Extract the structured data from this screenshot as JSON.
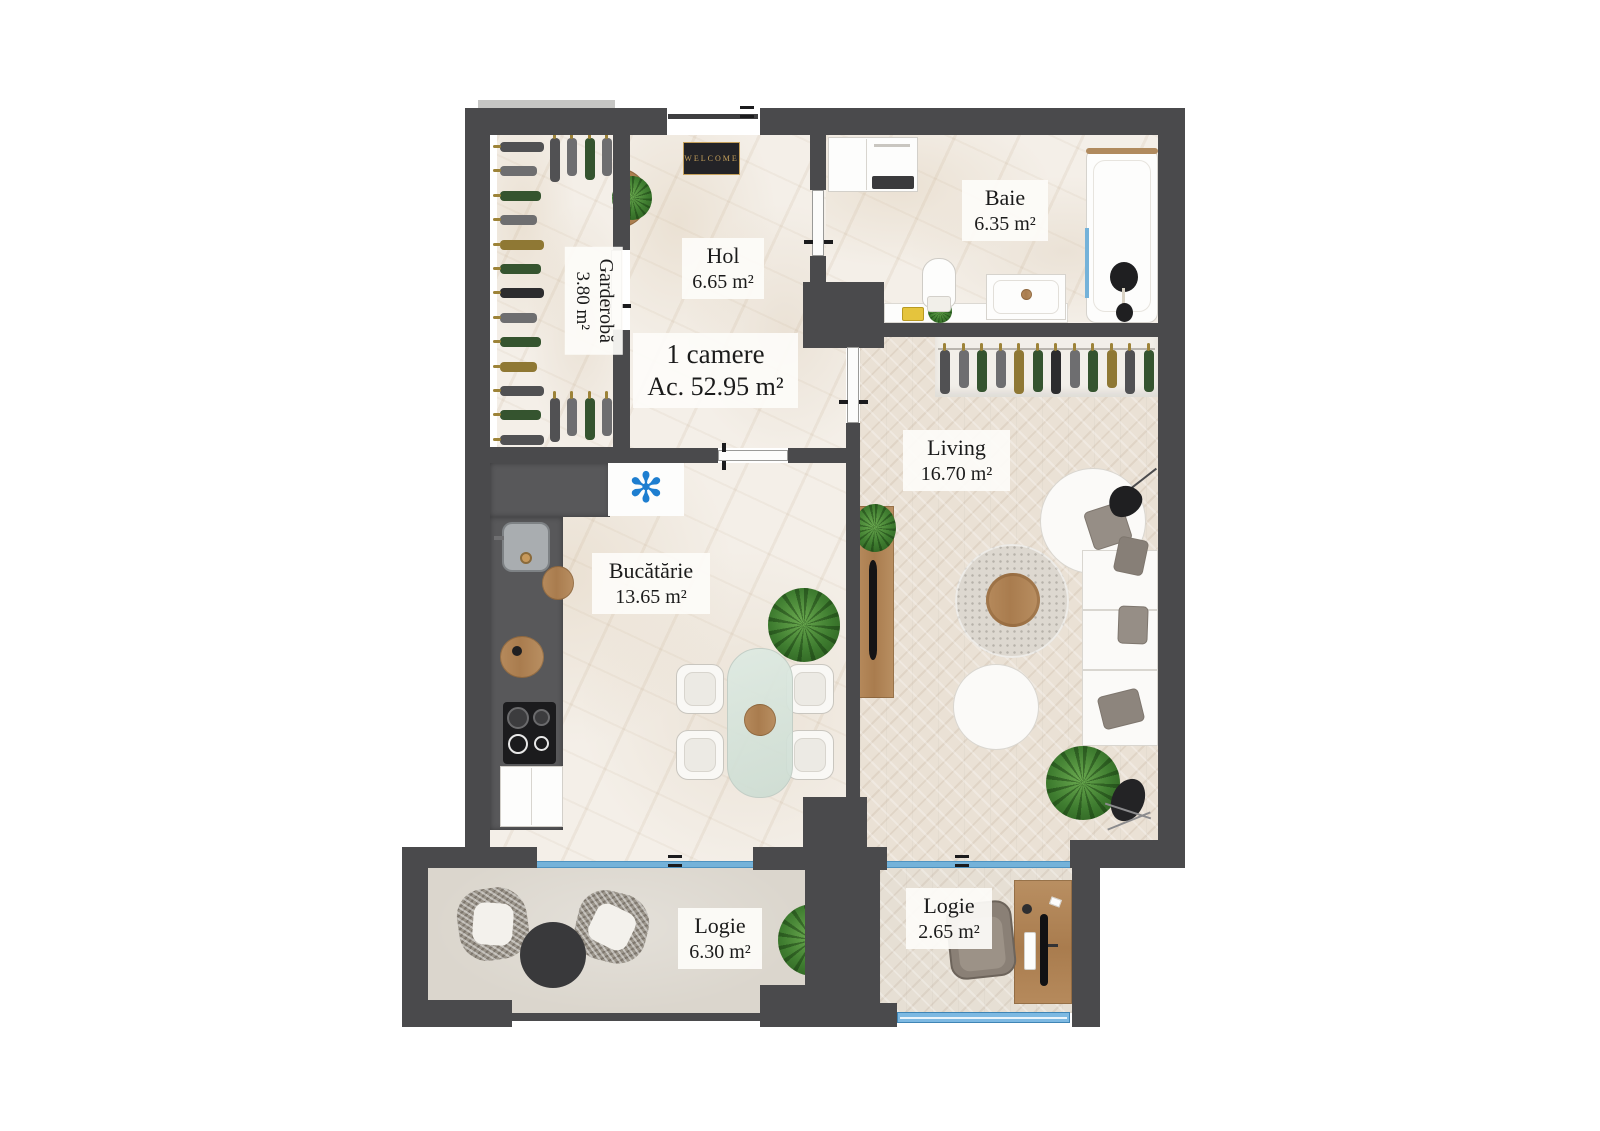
{
  "plan": {
    "title": {
      "line1": "1 camere",
      "line2": "Ac. 52.95 m²"
    },
    "rooms": {
      "garderoba": {
        "name": "Garderobă",
        "area": "3.80 m²"
      },
      "hol": {
        "name": "Hol",
        "area": "6.65 m²"
      },
      "baie": {
        "name": "Baie",
        "area": "6.35 m²"
      },
      "living": {
        "name": "Living",
        "area": "16.70 m²"
      },
      "bucatarie": {
        "name": "Bucătărie",
        "area": "13.65 m²"
      },
      "logie_mare": {
        "name": "Logie",
        "area": "6.30 m²"
      },
      "logie_mica": {
        "name": "Logie",
        "area": "2.65 m²"
      }
    },
    "doormat_text": "WELCOME",
    "icons": {
      "ac_asterisk": "✻"
    },
    "colors": {
      "wall": "#4a4a4c",
      "window_blue": "#74b2d9",
      "asterisk_blue": "#1e7ed0",
      "doormat_gold": "#c5a05b"
    }
  }
}
